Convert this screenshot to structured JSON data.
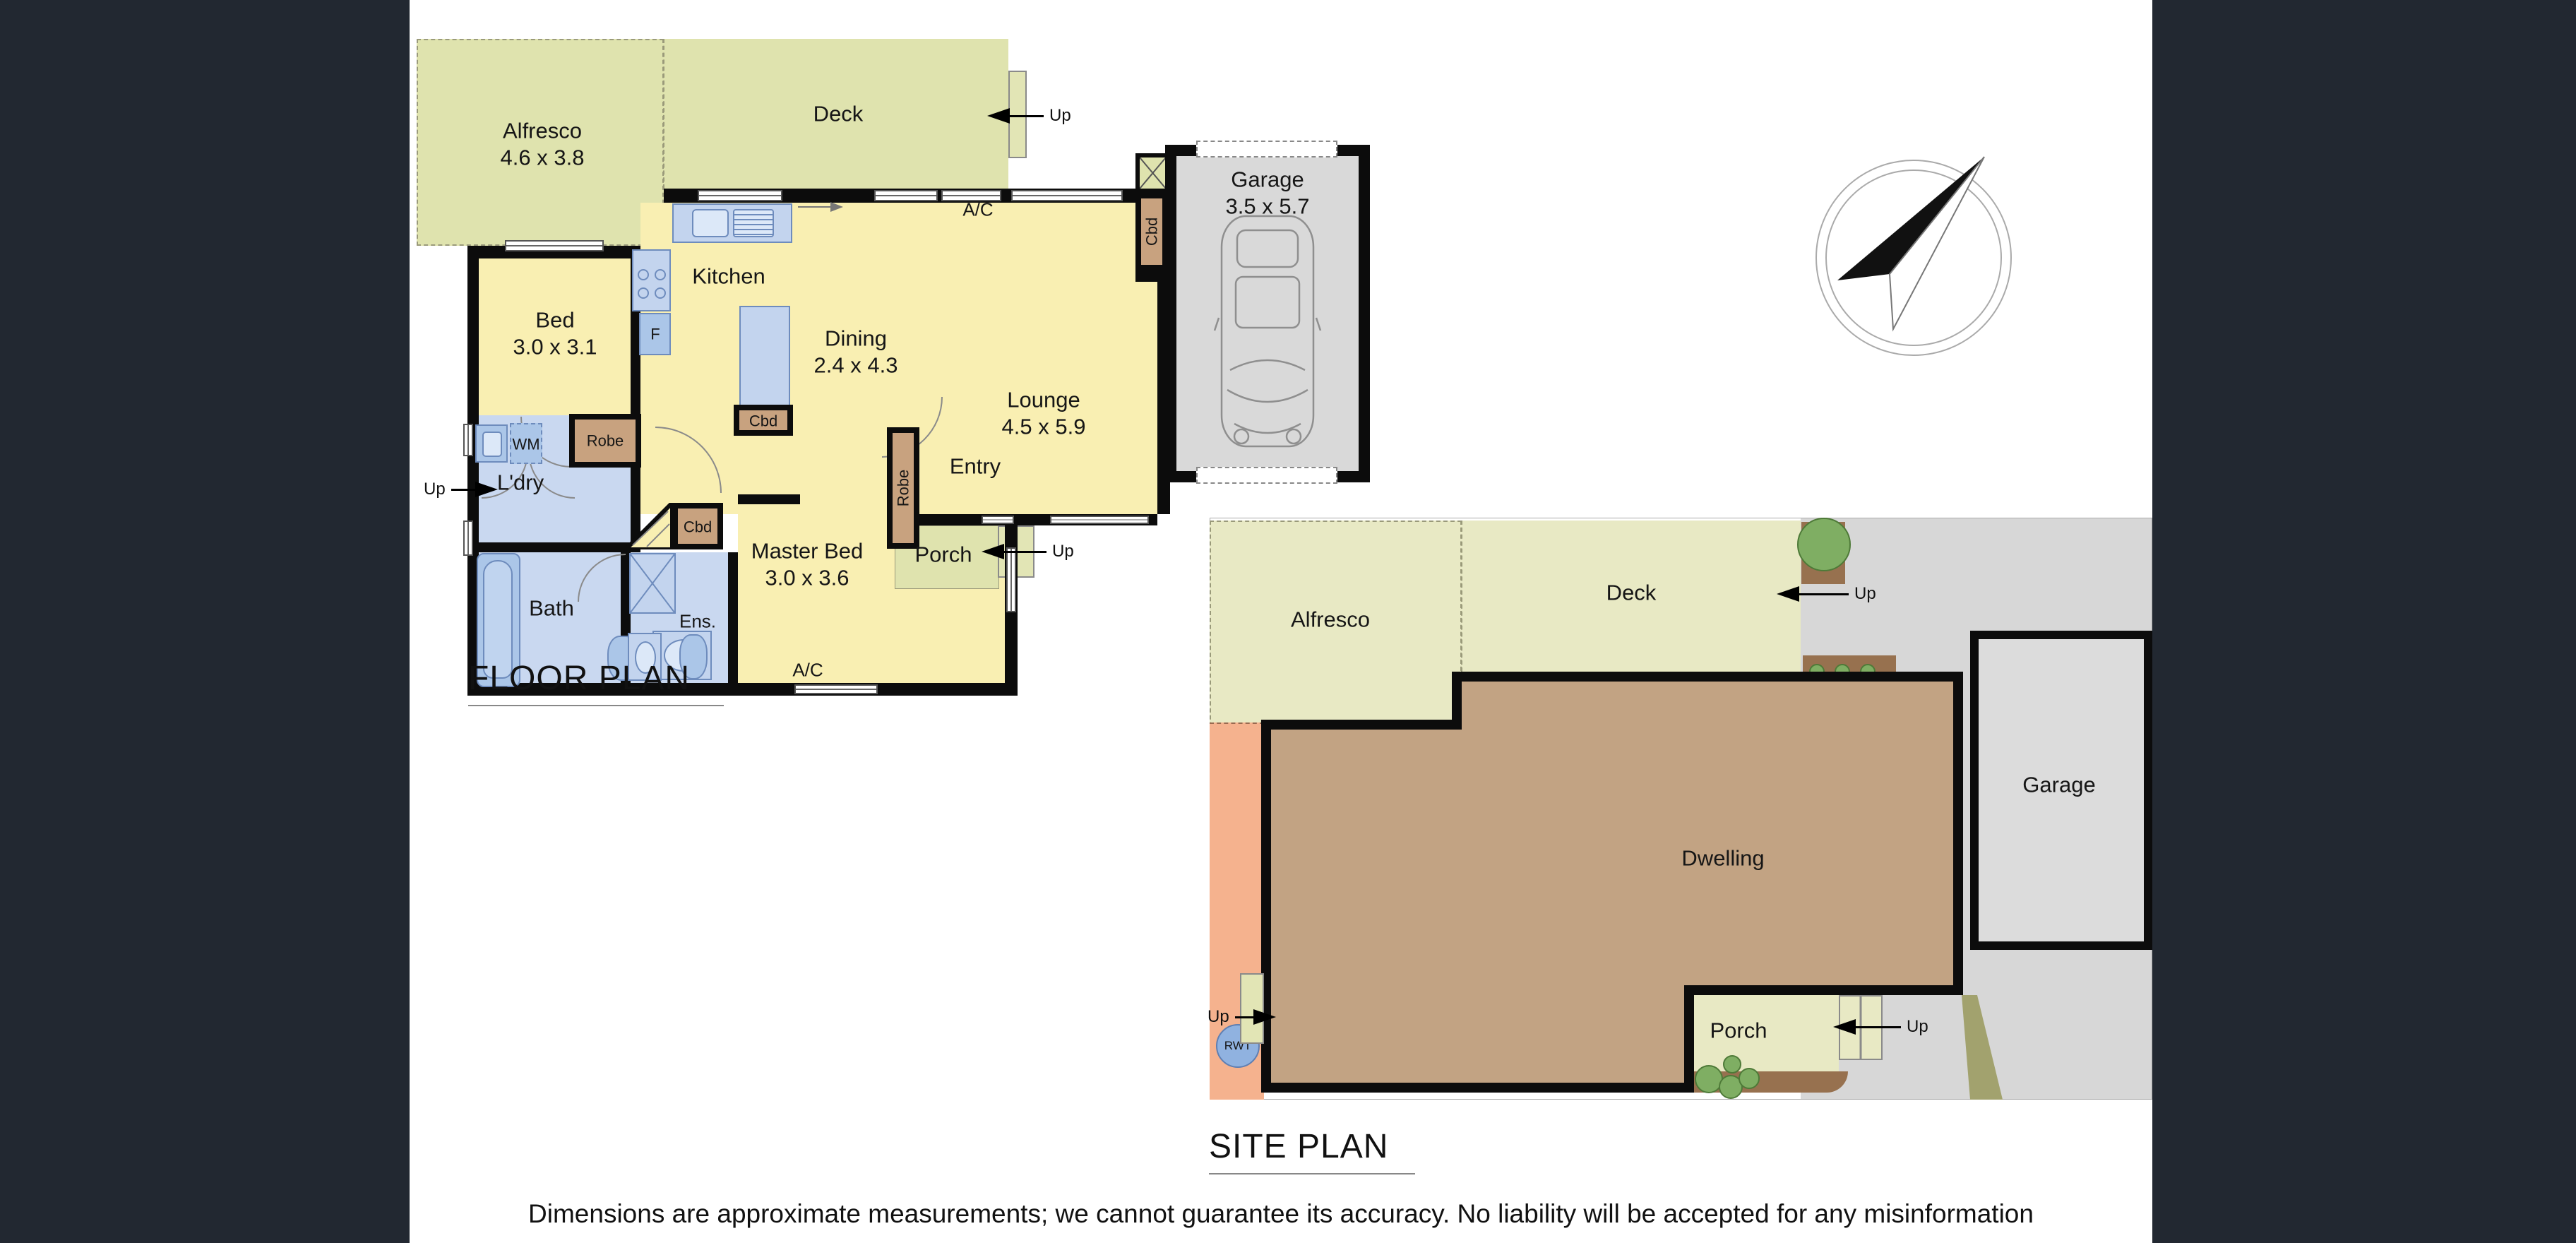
{
  "page": {
    "floor_plan_title": "FLOOR PLAN",
    "site_plan_title": "SITE PLAN",
    "disclaimer": "Dimensions are approximate measurements; we cannot guarantee its accuracy. No liability will be accepted for any misinformation"
  },
  "labels": {
    "up": "Up",
    "ac": "A/C",
    "wm": "WM",
    "fridge": "F",
    "robe": "Robe",
    "cupboard": "Cbd",
    "rwt": "RWT"
  },
  "floor_plan": {
    "rooms": {
      "alfresco": {
        "name": "Alfresco",
        "dims": "4.6 x 3.8"
      },
      "deck": {
        "name": "Deck"
      },
      "garage": {
        "name": "Garage",
        "dims": "3.5 x 5.7"
      },
      "kitchen": {
        "name": "Kitchen"
      },
      "dining": {
        "name": "Dining",
        "dims": "2.4 x 4.3"
      },
      "lounge": {
        "name": "Lounge",
        "dims": "4.5 x 5.9"
      },
      "bed": {
        "name": "Bed",
        "dims": "3.0 x 3.1"
      },
      "laundry": {
        "name": "L'dry"
      },
      "bath": {
        "name": "Bath"
      },
      "ensuite": {
        "name": "Ens."
      },
      "master_bed": {
        "name": "Master Bed",
        "dims": "3.0 x 3.6"
      },
      "entry": {
        "name": "Entry"
      },
      "porch": {
        "name": "Porch"
      }
    }
  },
  "site_plan": {
    "areas": {
      "alfresco": "Alfresco",
      "deck": "Deck",
      "dwelling": "Dwelling",
      "garage": "Garage",
      "porch": "Porch"
    }
  },
  "colors": {
    "background_dark": "#222831",
    "outdoor_olive": "#dfe3ae",
    "interior_yellow": "#f9efb2",
    "wet_area_blue": "#c9d8f0",
    "fixture_blue": "#abc6e8",
    "joinery_tan": "#c8a27f",
    "garage_grey": "#d9d9d9",
    "site_dwelling_tan": "#c2a383",
    "site_salmon": "#f5b28e",
    "garden_brown": "#97714f",
    "shrub_green": "#7fae63",
    "rwt_blue": "#90b2e0"
  }
}
